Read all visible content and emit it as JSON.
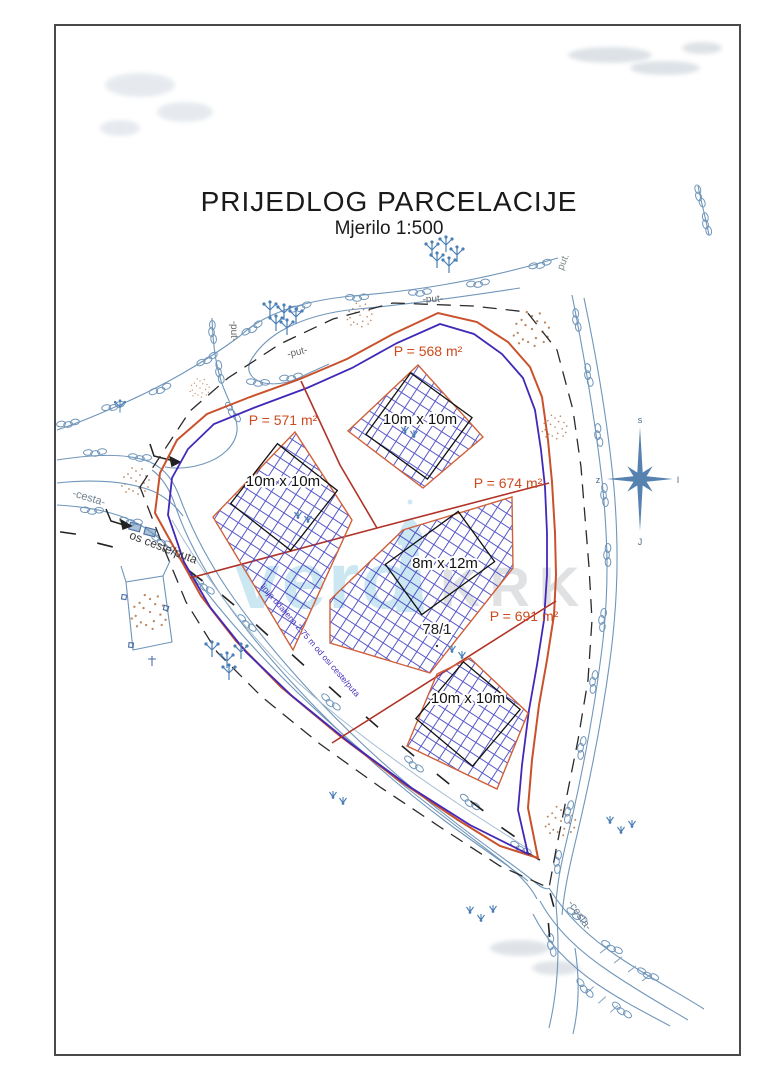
{
  "document": {
    "title": "PRIJEDLOG PARCELACIJE",
    "subtitle": "Mjerilo 1:500"
  },
  "plot_number": "78/1",
  "parcels": [
    {
      "id": "parcel-571",
      "area": "P = 571 m²",
      "building": "10m x 10m"
    },
    {
      "id": "parcel-568",
      "area": "P = 568 m²",
      "building": "10m x 10m"
    },
    {
      "id": "parcel-674",
      "area": "P = 674 m²",
      "building": "8m x 12m"
    },
    {
      "id": "parcel-691",
      "area": "P = 691 m²",
      "building": "10m x 10m"
    }
  ],
  "labels": {
    "road_left": "-cesta-",
    "road_axis": "os ceste/puta",
    "road_bottom_right": "-cesta-",
    "path_top": "-put-",
    "path_top2": "-put-",
    "path_vertical": "-put-",
    "path_top_right": "put.",
    "setback_line": "linija udaljena 2,75 m od osi ceste/puta"
  },
  "compass": {
    "n": "s",
    "s": "J",
    "w": "z",
    "e": "I"
  },
  "watermark": {
    "word": "vero",
    "word2": "KRK"
  },
  "colors": {
    "boundary_red": "#c9512c",
    "division_red": "#b03328",
    "building_line_purple": "#4128b8",
    "hatch_blue": "#3b3bc0",
    "road_blue": "#7096ba",
    "vegetation_blue": "#4a7fb5",
    "soil_brown": "#b07447",
    "area_text_red": "#cc4a1e"
  }
}
